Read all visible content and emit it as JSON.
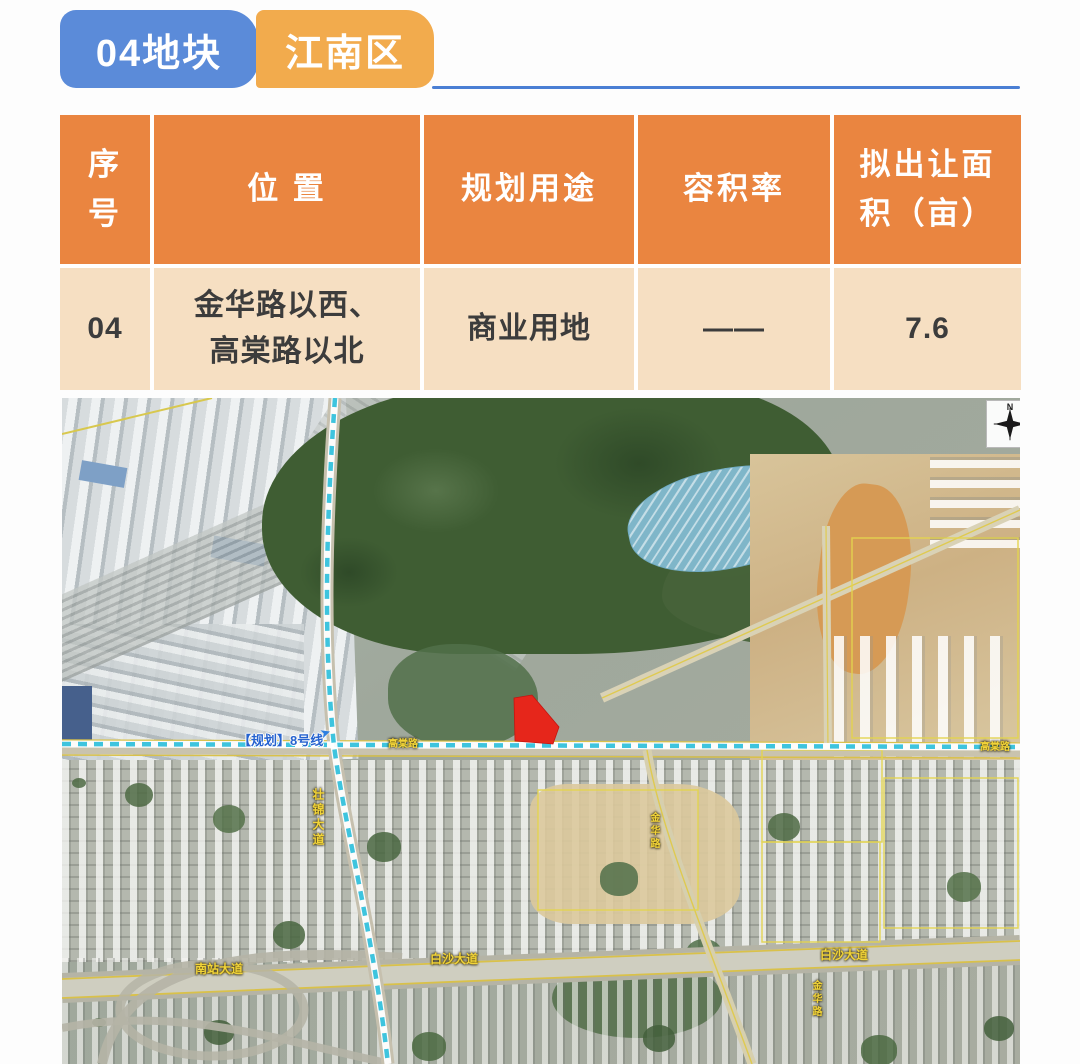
{
  "header": {
    "tab_block": "04地块",
    "tab_district": "江南区"
  },
  "table": {
    "columns": [
      {
        "label": "序\n号"
      },
      {
        "label": "位 置"
      },
      {
        "label": "规划用途"
      },
      {
        "label": "容积率"
      },
      {
        "label": "拟出让面\n积（亩）"
      }
    ],
    "row": {
      "no": "04",
      "location": "金华路以西、\n高棠路以北",
      "usage": "商业用地",
      "plot_ratio": "——",
      "area": "7.6"
    }
  },
  "map": {
    "compass": "N",
    "labels": {
      "metro_line8": "【规划】8号线",
      "zhuangjin_ave": "壮锦大道",
      "gaotang_left": "高棠路",
      "gaotang_right": "高棠路",
      "nanzhan_ave": "南站大道",
      "baisha_center": "白沙大道",
      "baisha_right": "白沙大道",
      "jinhua_upper": "金华路",
      "jinhua_lower": "金华路"
    }
  },
  "colors": {
    "tab_blue": "#5b8bd9",
    "tab_orange": "#f2ab4d",
    "table_header_orange": "#ea8540",
    "table_row_cream": "#f6dfc2",
    "parcel_red": "#e6261b",
    "metro_cyan": "#3ec4de",
    "road_label_yellow": "#f2d438",
    "metro_label_blue": "#2663cf"
  }
}
